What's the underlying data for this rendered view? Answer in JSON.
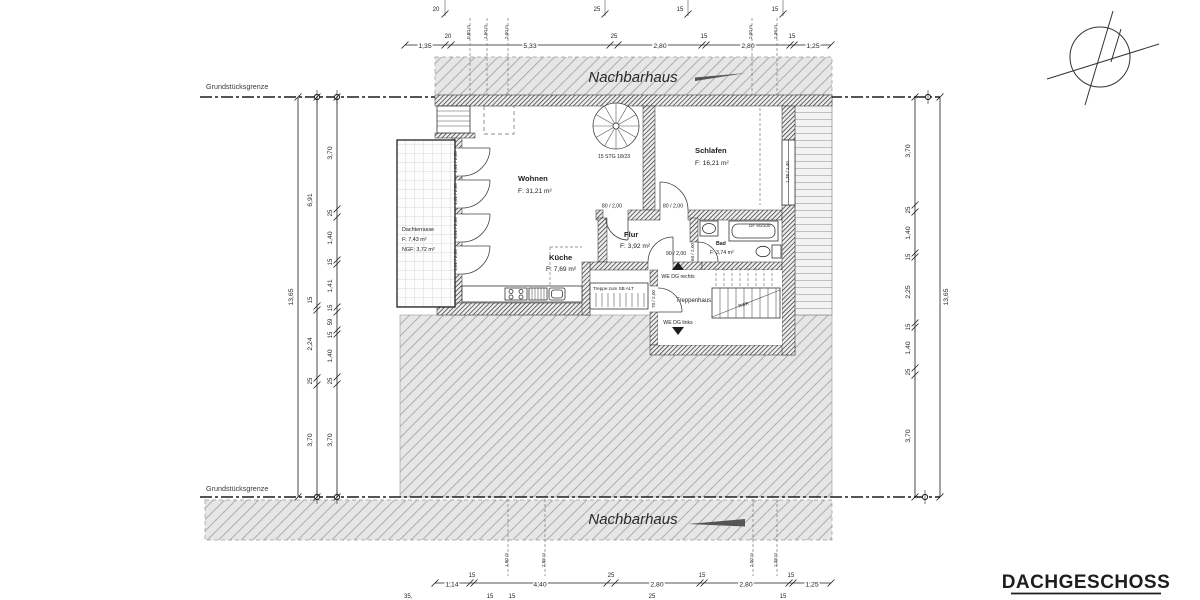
{
  "meta": {
    "drawing_title": "DACHGESCHOSS"
  },
  "colors": {
    "paper": "#ffffff",
    "ink": "#1d1d1d",
    "hatch_bg": "#e6e6e6",
    "hatch_line": "#9f9f9f",
    "wall_line": "#2f2f2f"
  },
  "site": {
    "boundary_top": "Grundstücksgrenze",
    "boundary_bottom": "Grundstücksgrenze",
    "neighbor_top": "Nachbarhaus",
    "neighbor_bottom": "Nachbarhaus"
  },
  "rooms": {
    "wohnen": {
      "name": "Wohnen",
      "area": "F: 31,21 m²"
    },
    "schlafen": {
      "name": "Schlafen",
      "area": "F: 16,21 m²"
    },
    "flur": {
      "name": "Flur",
      "area": "F: 3,92 m²"
    },
    "kueche": {
      "name": "Küche",
      "area": "F: 7,69 m²"
    },
    "bad": {
      "name": "Bad",
      "area": "F: 3,74 m²"
    },
    "dachterrasse": {
      "name": "Dachterrasse",
      "area": "F:    7,43 m²",
      "ngf": "NGF: 3,72 m²"
    },
    "treppenhaus": {
      "name": "Treppenhaus"
    },
    "treppe_sb": {
      "name": "Treppe zum SB ALT"
    }
  },
  "annotations": {
    "spiral_stair": "15 STG 18/23",
    "we_dg_rechts": "WE DG rechts",
    "we_dg_links": "WE DG links",
    "rwa": "RWA",
    "df_window": "DF 60/100"
  },
  "doors": {
    "terrace": [
      "1,01 / 2,00",
      "1,01 / 2,00",
      "1,01 / 2,00",
      "1,01 / 2,00"
    ],
    "wohnen_flur": "80 / 2,00",
    "schlafen": "80 / 2,00",
    "entry_right": "90 / 2,00",
    "entry_left": "70 / 2,00",
    "bad": "60 / 2,00",
    "window_schlafen": "1,38 / 1,40"
  },
  "dims": {
    "top_outer": [
      "20",
      "25",
      "15",
      "15"
    ],
    "top": [
      "1,35",
      "20",
      "5,33",
      "25",
      "2,80",
      "15",
      "2,80",
      "15",
      "1,25"
    ],
    "top_heights": [
      "0,80 m",
      "1,50 m",
      "2,00 m",
      "2,00 m",
      "1,36 m"
    ],
    "bottom": [
      "1,14",
      "15",
      "4,40",
      "25",
      "2,80",
      "15",
      "2,80",
      "15",
      "1,25"
    ],
    "bottom_outer": [
      "35,",
      "15",
      "15",
      "25",
      "15"
    ],
    "bottom_heights": [
      "1,90 m",
      "2,85 m",
      "2,00 m",
      "1,38 m"
    ],
    "left_total": "13,65",
    "left_mid": [
      "6,91",
      "15",
      "2,24",
      "25",
      "3,70"
    ],
    "left_inner": [
      "3,70",
      "25",
      "1,40",
      "15",
      "1,41",
      "15",
      "59",
      "15",
      "1,40",
      "25",
      "3,70"
    ],
    "right_total": "13,65",
    "right_inner": [
      "3,70",
      "25",
      "1,40",
      "15",
      "2,25",
      "15",
      "1,40",
      "25",
      "3,70"
    ]
  }
}
